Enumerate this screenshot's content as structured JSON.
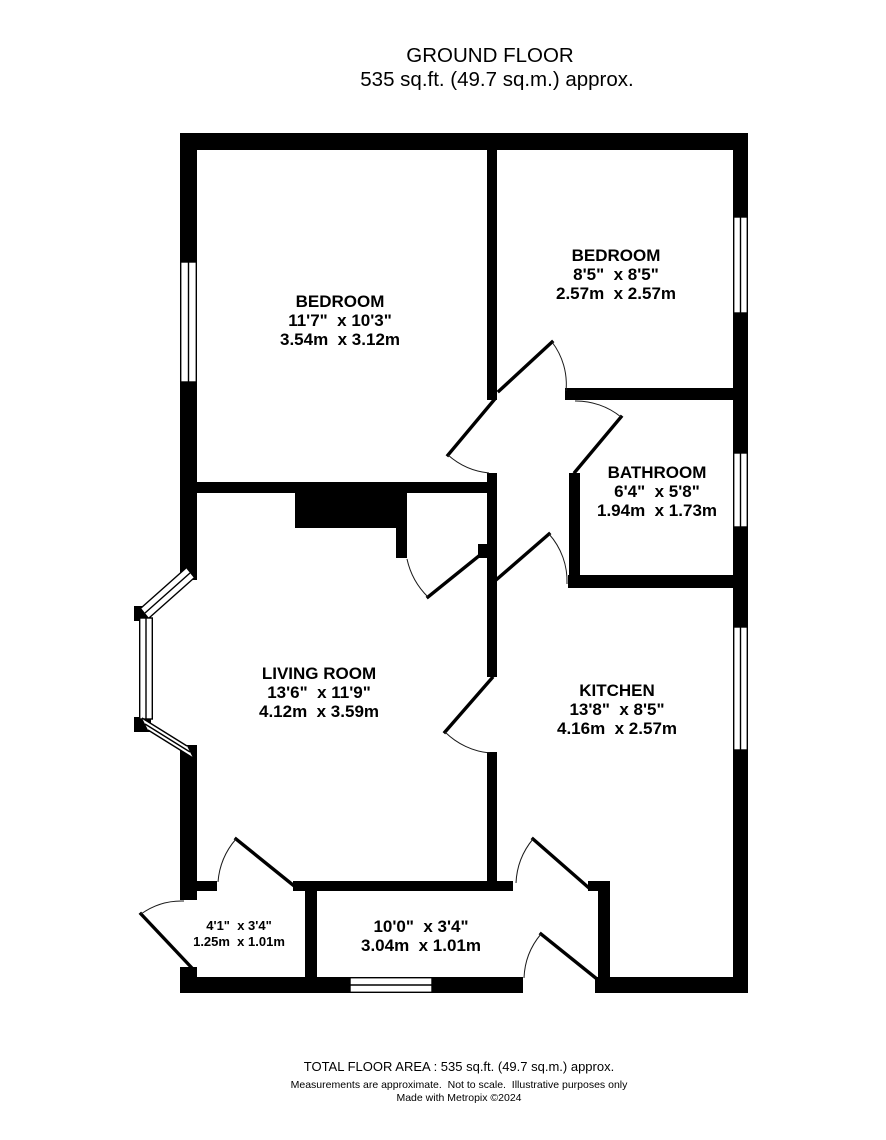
{
  "title": {
    "floor_name": "GROUND FLOOR",
    "floor_area": "535 sq.ft. (49.7 sq.m.) approx."
  },
  "rooms": {
    "bedroom_front": {
      "name": "BEDROOM",
      "imperial": "11'7\"  x 10'3\"",
      "metric": "3.54m  x 3.12m"
    },
    "bedroom_rear": {
      "name": "BEDROOM",
      "imperial": "8'5\"  x 8'5\"",
      "metric": "2.57m  x 2.57m"
    },
    "bathroom": {
      "name": "BATHROOM",
      "imperial": "6'4\"  x 5'8\"",
      "metric": "1.94m  x 1.73m"
    },
    "living_room": {
      "name": "LIVING ROOM",
      "imperial": "13'6\"  x 11'9\"",
      "metric": "4.12m  x 3.59m"
    },
    "kitchen": {
      "name": "KITCHEN",
      "imperial": "13'8\"  x 8'5\"",
      "metric": "4.16m  x 2.57m"
    },
    "hallway": {
      "imperial": "10'0\"  x 3'4\"",
      "metric": "3.04m  x 1.01m"
    },
    "porch": {
      "imperial": "4'1\"  x 3'4\"",
      "metric": "1.25m  x 1.01m"
    }
  },
  "footer": {
    "total_area": "TOTAL FLOOR AREA : 535 sq.ft. (49.7 sq.m.) approx.",
    "disclaimer": "Measurements are approximate.  Not to scale.  Illustrative purposes only",
    "credit": "Made with Metropix ©2024"
  },
  "colors": {
    "wall": "#000000",
    "background": "#ffffff"
  }
}
